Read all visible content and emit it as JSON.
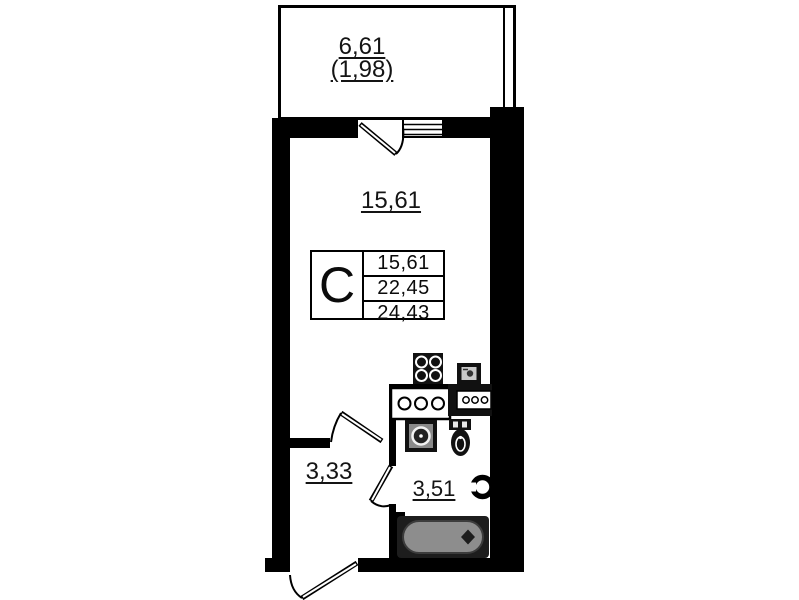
{
  "areas": {
    "balcony": "6,61",
    "balcony_reduced": "(1,98)",
    "room": "15,61",
    "hallway": "3,33",
    "bathroom": "3,51"
  },
  "legend": {
    "type_label": "C",
    "rows": [
      "15,61",
      "22,45",
      "24,43"
    ]
  },
  "colors": {
    "wall": "#000000",
    "background": "#ffffff",
    "bathtub_fill": "#8d8d8d"
  }
}
